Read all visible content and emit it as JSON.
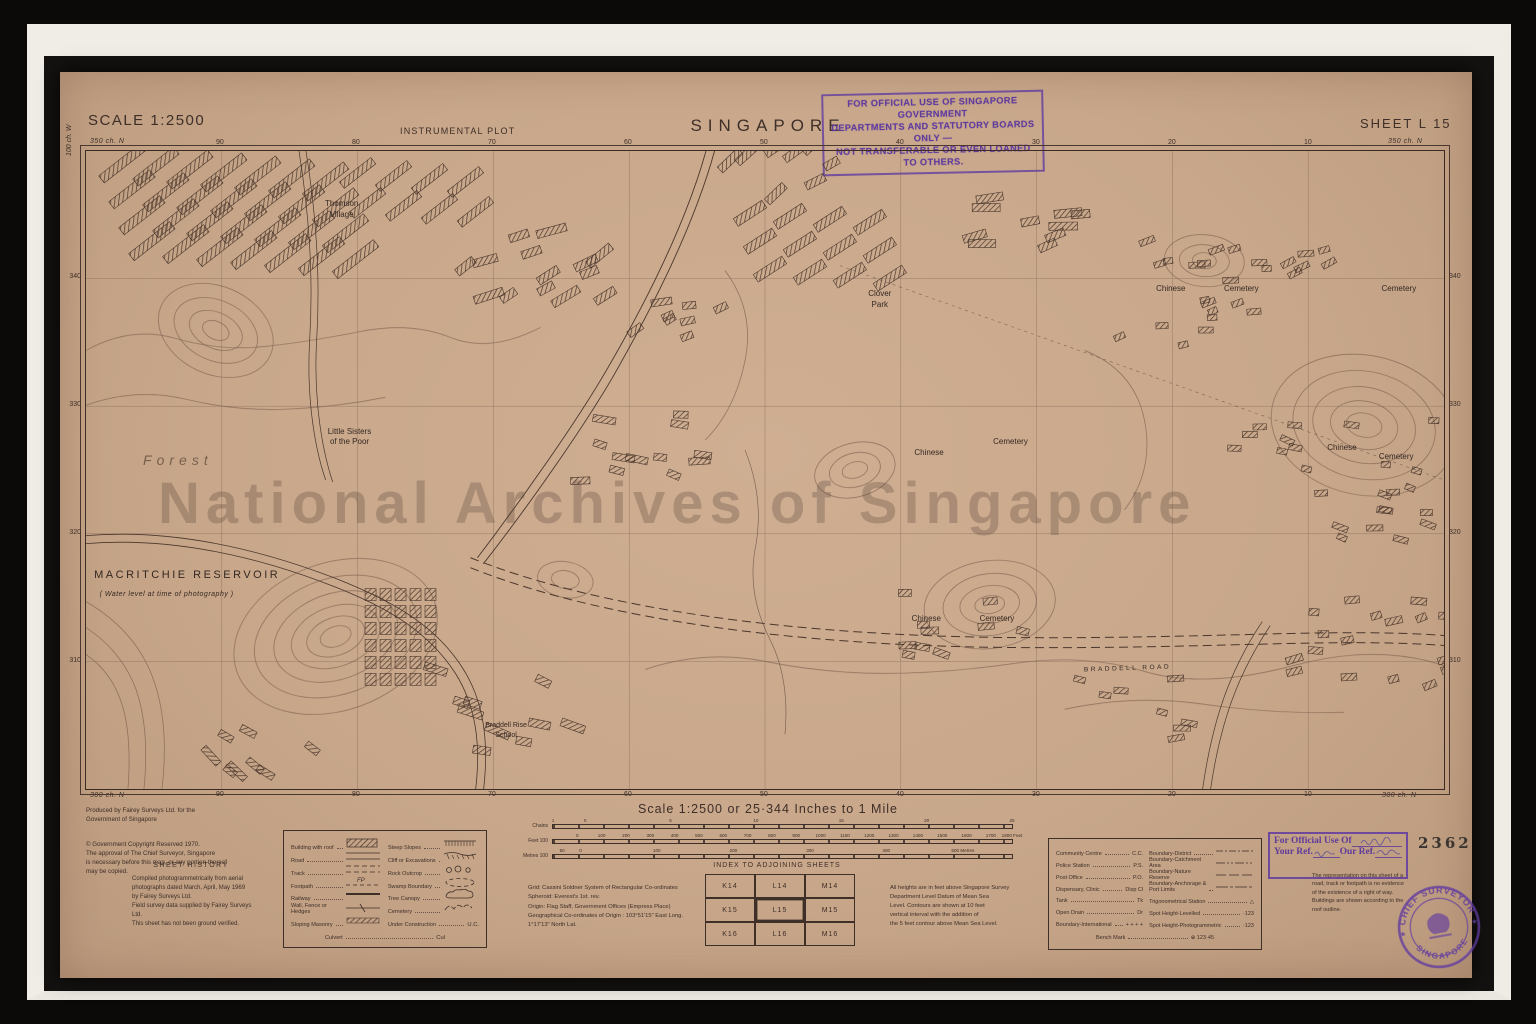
{
  "colors": {
    "paper": "#c8a78a",
    "ink": "#3e2f28",
    "contour": "#7a5f4e",
    "stamp_purple": "#623ca0",
    "frame_white": "#f0ede7"
  },
  "archive": {
    "watermark": "National Archives of Singapore",
    "accession_number": "2362"
  },
  "header": {
    "scale_label": "SCALE 1:2500",
    "plot_type": "INSTRUMENTAL PLOT",
    "title": "SINGAPORE",
    "sheet": "SHEET L 15",
    "official_stamp": "FOR OFFICIAL USE OF SINGAPORE GOVERNMENT\nDEPARTMENTS AND STATUTORY BOARDS ONLY —\nNOT TRANSFERABLE OR EVEN LOANED TO OTHERS."
  },
  "map": {
    "corner_labels": {
      "top_left": "350 ch. N",
      "top_right": "350 ch. N",
      "bottom_left": "300 ch. N",
      "bottom_right": "300 ch. N",
      "left_vertical": "100 ch. W"
    },
    "top_numbers": [
      "90",
      "80",
      "70",
      "60",
      "50",
      "40",
      "30",
      "20",
      "10"
    ],
    "bottom_numbers": [
      "90",
      "80",
      "70",
      "60",
      "50",
      "40",
      "30",
      "20",
      "10"
    ],
    "left_numbers": [
      "340",
      "330",
      "320",
      "310"
    ],
    "right_numbers": [
      "340",
      "330",
      "320",
      "310"
    ],
    "labels": [
      {
        "text": "Forest",
        "x": 4.2,
        "y": 47.0,
        "cls": "lbl-forest"
      },
      {
        "text": "Thomson\nVillage",
        "x": 17.6,
        "y": 7.6,
        "cls": "lbl-sm"
      },
      {
        "text": "Little Sisters\nof the Poor",
        "x": 17.8,
        "y": 43.2,
        "cls": "lbl-sm"
      },
      {
        "text": "Clover\nPark",
        "x": 57.6,
        "y": 21.6,
        "cls": "lbl-sm"
      },
      {
        "text": "Chinese",
        "x": 61.0,
        "y": 46.6,
        "cls": "lbl-sm"
      },
      {
        "text": "Cemetery",
        "x": 66.8,
        "y": 44.8,
        "cls": "lbl-sm"
      },
      {
        "text": "Chinese",
        "x": 60.8,
        "y": 72.6,
        "cls": "lbl-sm"
      },
      {
        "text": "Cemetery",
        "x": 65.8,
        "y": 72.6,
        "cls": "lbl-sm"
      },
      {
        "text": "Chinese",
        "x": 91.4,
        "y": 45.8,
        "cls": "lbl-sm"
      },
      {
        "text": "Cemetery",
        "x": 95.2,
        "y": 47.2,
        "cls": "lbl-sm"
      },
      {
        "text": "Chinese",
        "x": 78.8,
        "y": 20.8,
        "cls": "lbl-sm"
      },
      {
        "text": "Cemetery",
        "x": 83.8,
        "y": 20.8,
        "cls": "lbl-sm"
      },
      {
        "text": "Cemetery",
        "x": 95.4,
        "y": 20.8,
        "cls": "lbl-sm"
      },
      {
        "text": "Braddell Rise\nSchool",
        "x": 29.4,
        "y": 89.4,
        "cls": "lbl-xs"
      },
      {
        "text": "BRADDELL    ROAD",
        "x": 73.5,
        "y": 80.6,
        "cls": "lbl-road"
      },
      {
        "text": "MACRITCHIE   RESERVOIR",
        "x": 0.6,
        "y": 65.4,
        "cls": "lbl-reservoir"
      },
      {
        "text": "( Water level at time of photography )",
        "x": 1.0,
        "y": 68.8,
        "cls": "lbl-reservoir-sub"
      }
    ],
    "clusters": [
      {
        "type": "rows",
        "x": 10,
        "y": 8,
        "perRow": 7,
        "dx": 34,
        "dy": 26,
        "rows": 4,
        "w": 52,
        "h": 9,
        "angle": -38
      },
      {
        "type": "rows",
        "x": 252,
        "y": 18,
        "perRow": 4,
        "dx": 36,
        "dy": 30,
        "rows": 2,
        "w": 40,
        "h": 8,
        "angle": -38
      },
      {
        "type": "rows",
        "x": 648,
        "y": 58,
        "perRow": 4,
        "dx": 40,
        "dy": 28,
        "rows": 3,
        "w": 34,
        "h": 9,
        "angle": -33
      },
      {
        "type": "grid",
        "x": 285,
        "y": 445,
        "cols": 5,
        "rowsN": 6,
        "dx": 15,
        "dy": 17,
        "w": 11,
        "h": 12
      },
      {
        "type": "scatter",
        "cx": 450,
        "cy": 120,
        "count": 14,
        "w": 24,
        "h": 8,
        "angle": -25,
        "spread": 70,
        "seed": 11
      },
      {
        "type": "scatter",
        "cx": 560,
        "cy": 300,
        "count": 12,
        "w": 18,
        "h": 7,
        "angle": 10,
        "spread": 65,
        "seed": 22
      },
      {
        "type": "scatter",
        "cx": 700,
        "cy": 20,
        "count": 8,
        "w": 22,
        "h": 8,
        "angle": -33,
        "spread": 55,
        "seed": 33
      },
      {
        "type": "scatter",
        "cx": 1140,
        "cy": 150,
        "count": 26,
        "w": 13,
        "h": 6,
        "angle": -15,
        "spread": 105,
        "seed": 44
      },
      {
        "type": "scatter",
        "cx": 1250,
        "cy": 330,
        "count": 24,
        "w": 13,
        "h": 6,
        "angle": 10,
        "spread": 100,
        "seed": 55
      },
      {
        "type": "scatter",
        "cx": 1300,
        "cy": 490,
        "count": 18,
        "w": 14,
        "h": 7,
        "angle": -10,
        "spread": 90,
        "seed": 66
      },
      {
        "type": "scatter",
        "cx": 880,
        "cy": 470,
        "count": 10,
        "w": 16,
        "h": 7,
        "angle": 5,
        "spread": 60,
        "seed": 77
      },
      {
        "type": "scatter",
        "cx": 950,
        "cy": 80,
        "count": 10,
        "w": 24,
        "h": 8,
        "angle": -12,
        "spread": 60,
        "seed": 88
      },
      {
        "type": "scatter",
        "cx": 420,
        "cy": 560,
        "count": 10,
        "w": 20,
        "h": 8,
        "angle": 20,
        "spread": 70,
        "seed": 99
      },
      {
        "type": "scatter",
        "cx": 180,
        "cy": 600,
        "count": 8,
        "w": 18,
        "h": 7,
        "angle": 35,
        "spread": 55,
        "seed": 111
      },
      {
        "type": "scatter",
        "cx": 1050,
        "cy": 560,
        "count": 8,
        "w": 14,
        "h": 6,
        "angle": 0,
        "spread": 55,
        "seed": 122
      },
      {
        "type": "scatter",
        "cx": 600,
        "cy": 180,
        "count": 8,
        "w": 16,
        "h": 7,
        "angle": -20,
        "spread": 50,
        "seed": 133
      }
    ]
  },
  "scale_bars": {
    "title": "Scale 1:2500 or 25·344 Inches to 1 Mile",
    "bars": [
      {
        "label": "Chains",
        "ticks": [
          {
            "t": "1",
            "p": 0
          },
          {
            "t": "0",
            "p": 7
          },
          {
            "t": "5",
            "p": 25.6
          },
          {
            "t": "10",
            "p": 44.2
          },
          {
            "t": "15",
            "p": 62.8
          },
          {
            "t": "20",
            "p": 81.4
          },
          {
            "t": "25",
            "p": 100
          }
        ]
      },
      {
        "label": "Feet 100",
        "ticks": [
          {
            "t": "0",
            "p": 5.3
          },
          {
            "t": "100",
            "p": 10.6
          },
          {
            "t": "200",
            "p": 15.9
          },
          {
            "t": "300",
            "p": 21.2
          },
          {
            "t": "400",
            "p": 26.5
          },
          {
            "t": "500",
            "p": 31.8
          },
          {
            "t": "600",
            "p": 37.1
          },
          {
            "t": "700",
            "p": 42.4
          },
          {
            "t": "800",
            "p": 47.7
          },
          {
            "t": "900",
            "p": 53
          },
          {
            "t": "1000",
            "p": 58.3
          },
          {
            "t": "1100",
            "p": 63.6
          },
          {
            "t": "1200",
            "p": 68.9
          },
          {
            "t": "1300",
            "p": 74.2
          },
          {
            "t": "1400",
            "p": 79.5
          },
          {
            "t": "1500",
            "p": 84.8
          },
          {
            "t": "1600",
            "p": 90.1
          },
          {
            "t": "1700",
            "p": 95.4
          },
          {
            "t": "1800 Feet",
            "p": 100
          }
        ]
      },
      {
        "label": "Metres 100",
        "ticks": [
          {
            "t": "50",
            "p": 2
          },
          {
            "t": "0",
            "p": 6
          },
          {
            "t": "100",
            "p": 22.6
          },
          {
            "t": "200",
            "p": 39.3
          },
          {
            "t": "300",
            "p": 56
          },
          {
            "t": "400",
            "p": 72.6
          },
          {
            "t": "500 Metres",
            "p": 89.3
          }
        ]
      }
    ]
  },
  "imprint": {
    "produced": "Produced by Fairey Surveys Ltd. for the\nGovernment of Singapore",
    "copyright": "© Government Copyright Reserved 1970.\nThe approval of The Chief Surveyor, Singapore\nis necessary before this map, or any portion thereof\nmay be copied.",
    "history_title": "SHEET HISTORY",
    "history": "Compiled photogrammetrically from aerial\nphotographs dated March, April, May 1969\nby Fairey Surveys Ltd.\nField survey data supplied by Fairey Surveys\nLtd.\nThis sheet has not been ground verified."
  },
  "legend_symbols": {
    "left": [
      {
        "label": "Building with roof",
        "sym": "building"
      },
      {
        "label": "Road",
        "sym": "road"
      },
      {
        "label": "Track",
        "sym": "track"
      },
      {
        "label": "Footpath",
        "sym": "footpath"
      },
      {
        "label": "Railway",
        "sym": "railway"
      },
      {
        "label": "Wall, Fence or Hedges",
        "sym": "fence"
      },
      {
        "label": "Sloping Masonry",
        "sym": "masonry"
      }
    ],
    "right": [
      {
        "label": "Steep Slopes",
        "sym": "steep"
      },
      {
        "label": "Cliff or Excavations",
        "sym": "cliff"
      },
      {
        "label": "Rock Outcrop",
        "sym": "rock"
      },
      {
        "label": "Swamp Boundary",
        "sym": "swamp"
      },
      {
        "label": "Tree Canopy",
        "sym": "canopy"
      },
      {
        "label": "Cemetery",
        "sym": "cemetery"
      },
      {
        "label": "Under Construction",
        "sym": "uc",
        "abbr": "U.C."
      }
    ],
    "bottom": {
      "label": "Culvert",
      "abbr": "Cul"
    }
  },
  "projection": {
    "notes": "Grid:      Cassini Soldner System of Rectangular Co-ordinates\nSpheroid:  Everest's 1st. rev.\nOrigin:    Flag Staff, Government Offices (Empress Place)\nGeographical Co-ordinates of Origin : 103°51'15\" East Long.\n                         1°17'13\" North Lat."
  },
  "adjoining": {
    "title": "INDEX TO ADJOINING SHEETS",
    "rows": [
      [
        "K14",
        "L14",
        "M14"
      ],
      [
        "K15",
        "L15",
        "M15"
      ],
      [
        "K16",
        "L16",
        "M16"
      ]
    ],
    "current": "L15"
  },
  "heights_note": "All heights are in feet above Singapore Survey\nDepartment Level Datum of Mean Sea\nLevel. Contours are shown at 10 feet\nvertical interval with the addition of\nthe 5 feet contour above Mean Sea Level.",
  "legend_abbr": {
    "left": [
      {
        "label": "Community Centre",
        "abbr": "C.C."
      },
      {
        "label": "Police Station",
        "abbr": "P.S."
      },
      {
        "label": "Post Office",
        "abbr": "P.O."
      },
      {
        "label": "Dispensary, Clinic",
        "abbr": "Disp Cl"
      },
      {
        "label": "Tank",
        "abbr": "Tk"
      },
      {
        "label": "Open Drain",
        "abbr": "Dr"
      },
      {
        "label": "Boundary-International",
        "abbr": "+ + + +"
      }
    ],
    "right": [
      {
        "label": "Boundary-District",
        "dash": "7 2 2 2"
      },
      {
        "label": "Boundary-Catchment Area",
        "dash": "9 2 2 2 2 2"
      },
      {
        "label": "Boundary-Nature Reserve",
        "dash": "10 3"
      },
      {
        "label": "Boundary-Anchorage &\nPort Limits",
        "dash": "12 2 3 2"
      },
      {
        "label": "Trigonometrical Station",
        "text": "△"
      },
      {
        "label": "Spot Height-Levelled",
        "text": "·123"
      },
      {
        "label": "Spot Height-Photogrammetric",
        "text": "·123"
      }
    ],
    "bench": {
      "label": "Bench Mark",
      "text": "⊕ 123·45"
    }
  },
  "official_box": {
    "title": "For Official Use Of",
    "your_ref": "Your Ref.",
    "our_ref": "Our Ref."
  },
  "row_note": "The representation on this sheet of a\nroad, track or footpath is no evidence\nof the existence of a right of way.\nBuildings are shown according to the\nroof outline.",
  "round_stamp": {
    "arc_top": "CHIEF SURVEYOR",
    "arc_bottom": "SINGAPORE",
    "stars": "★"
  }
}
